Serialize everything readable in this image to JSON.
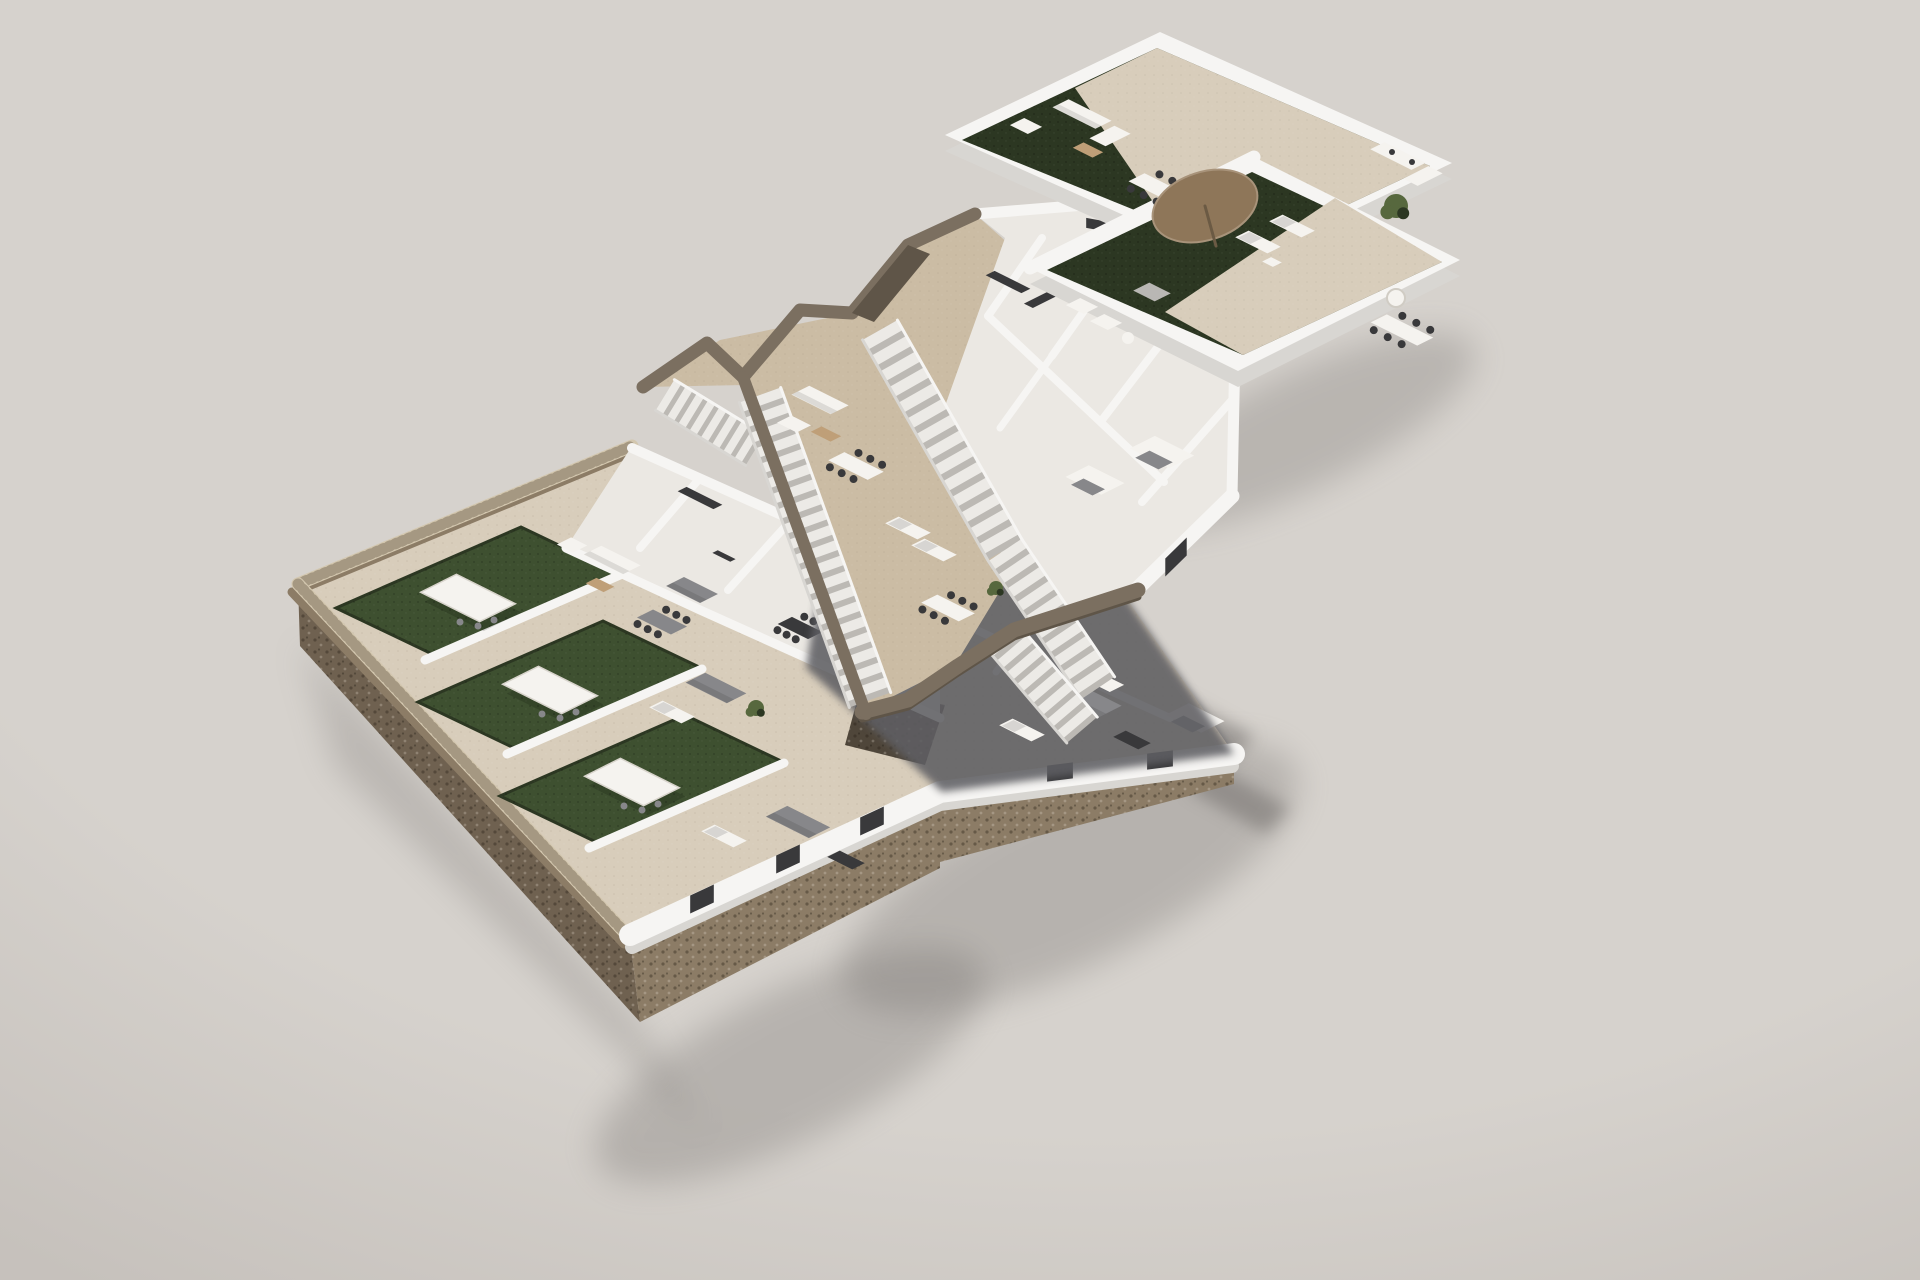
{
  "scene": {
    "title": "Exploded axonometric 3D render of a three-level residential building floor plan",
    "levels": [
      {
        "id": "roof-terrace",
        "label": "Roof terrace level with lawn decks, parasol lounge and outdoor dining"
      },
      {
        "id": "upper-floor",
        "label": "Upper floor with long exterior staircases, terraces and apartments"
      },
      {
        "id": "ground-floor",
        "label": "Ground floor apartments with private gardens, pergolas and gabion stone base"
      }
    ]
  },
  "colors": {
    "background": "#d6d2cd",
    "background_edge": "#c6c1bc",
    "wall_top": "#f6f5f3",
    "wall_light": "#ebe8e3",
    "wall_shade": "#d8d6d2",
    "wall_dark": "#bdbab6",
    "floor_tile": "#d8cdbb",
    "wood": "#cbbca4",
    "grass": "#3e5030",
    "grass_dark": "#2c3722",
    "stone_top": "#d3c7af",
    "stone_side": "#8c7c66",
    "stone_side_dark": "#6f6150",
    "rubble": "#4f463a",
    "fascia": "#7b6f60",
    "fascia_dark": "#5f5548",
    "step": "#eceae6",
    "step_shade": "#bcb9b4",
    "shadow": "#6f6c69",
    "slab_shadow": "#5e5f63",
    "furn_white": "#f5f3ef",
    "furn_gray": "#87878a",
    "furn_dark": "#39393b",
    "furn_wood": "#bf9f78",
    "parasol": "#8e7659",
    "plant": "#57683e"
  }
}
